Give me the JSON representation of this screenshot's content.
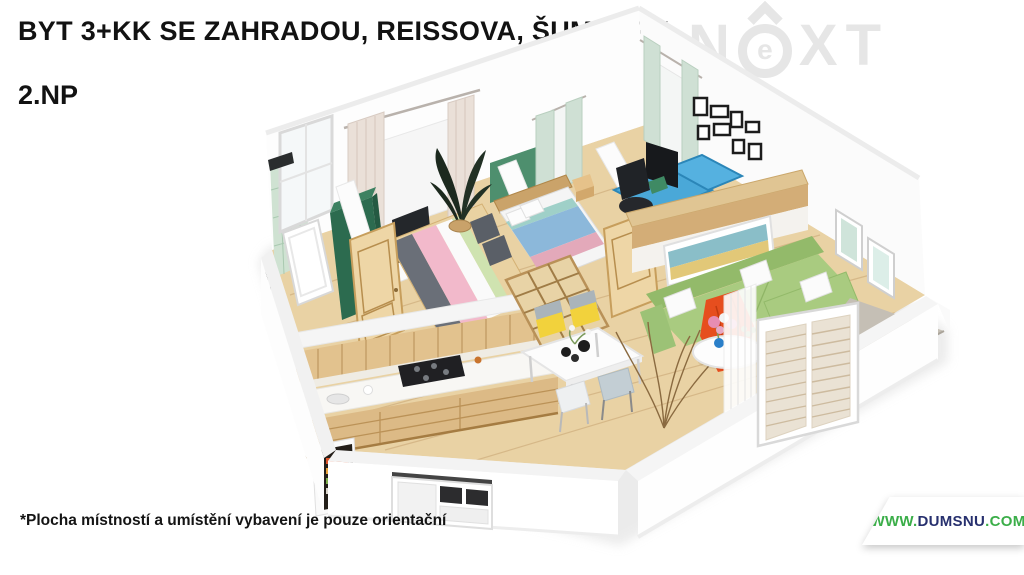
{
  "header": {
    "title": "BYT 3+KK SE ZAHRADOU, REISSOVA, ŠUMPERK",
    "floor_label": "2.NP"
  },
  "logo": {
    "name": "NEXT",
    "letter_n": "N",
    "letter_e": "e",
    "letter_x": "X",
    "letter_t": "T",
    "color": "#e6e6e6"
  },
  "footnote": "*Plocha místností a umístění vybavení je pouze orientační",
  "badge": {
    "www": "WWW.",
    "domain": "DUMSNU",
    "tld": ".COM",
    "green": "#3bae49",
    "navy": "#27306e"
  },
  "floorplan": {
    "type": "3d-isometric-apartment-render",
    "colors": {
      "floor_wood": "#e9d2a4",
      "wall_white": "#fdfdfd",
      "sofa_green": "#a9cb80",
      "sofa_green_dark": "#93ba6a",
      "wardrobe_green": "#2c6b4f",
      "tile_green": "#cfe2d2",
      "kitchen_wood": "#e2c28e",
      "kitchen_wood_dark": "#dcba86",
      "curtain_beige": "#eae0d8",
      "curtain_green": "#cfe0d4",
      "desk_blue": "#4aa8d8",
      "chair_black": "#26282c",
      "blanket_red": "#e64e1e",
      "bed_pink": "#f2b9cb",
      "bed_blue": "#8cb8da",
      "headboard_green": "#4e8f6e",
      "terrace_gray": "#c5bfb5",
      "door_wood": "#eed6a6"
    },
    "elements": [
      "bathroom-tiled-wall",
      "bathtub",
      "green-wardrobe",
      "wooden-door",
      "bed-pink",
      "plant-dark",
      "tv-cabinet",
      "bed-blue",
      "nightstand",
      "desk-blue",
      "office-chair",
      "monitor",
      "gallery-frames",
      "kitchen-upper-cabinets",
      "kitchen-counter",
      "cooktop",
      "sink",
      "kitchen-lower-cabinets",
      "fridge-open",
      "dining-table",
      "dining-chairs",
      "bookshelf-divider",
      "half-wall-wood",
      "panoramic-painting",
      "sofa-green-corner",
      "white-pillows",
      "red-blanket",
      "coffee-table-round",
      "flower-bouquet",
      "dry-plant",
      "sheer-curtain",
      "beige-curtains",
      "green-curtains",
      "wall-pictures",
      "french-window-blinds",
      "kitchen-window",
      "terrace-floor"
    ]
  }
}
